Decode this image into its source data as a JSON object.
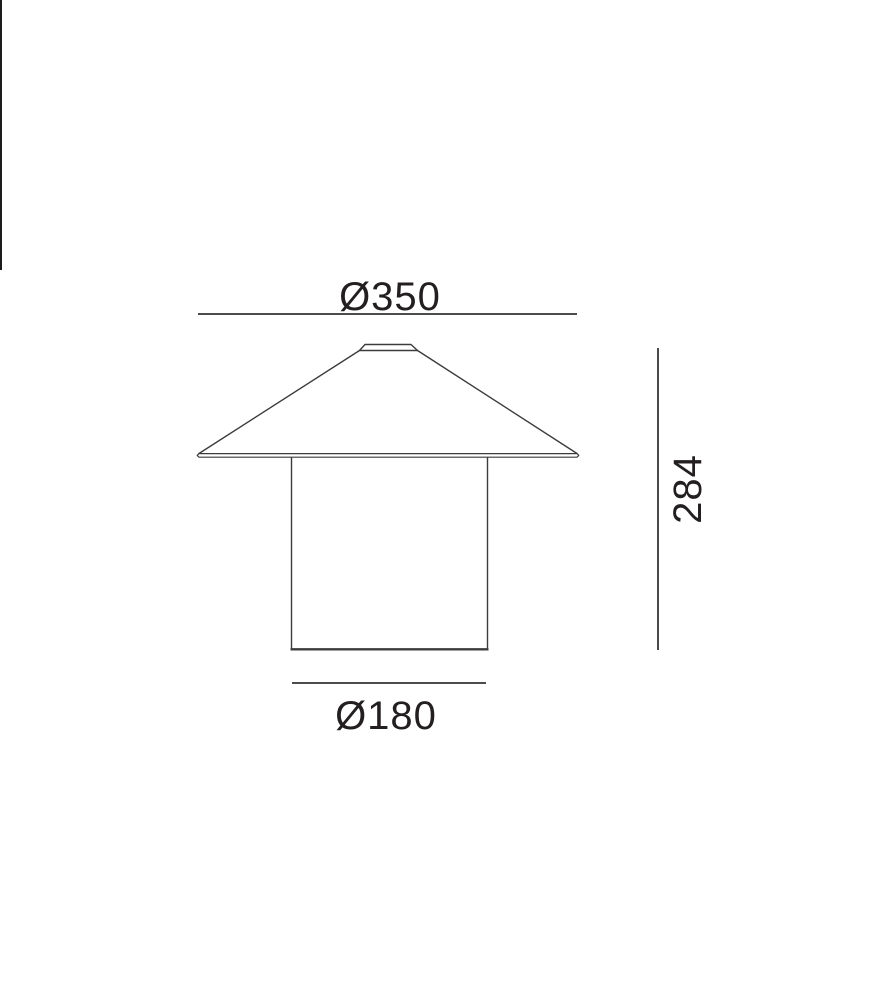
{
  "drawing": {
    "type": "lamp-dimension-drawing",
    "top_dimension": {
      "label": "Ø350"
    },
    "height_dimension": {
      "label": "284"
    },
    "bottom_dimension": {
      "label": "Ø180"
    },
    "colors": {
      "outline": "#3c3c3c",
      "dimension_line": "#333333",
      "text": "#231f20",
      "background": "#ffffff"
    }
  }
}
